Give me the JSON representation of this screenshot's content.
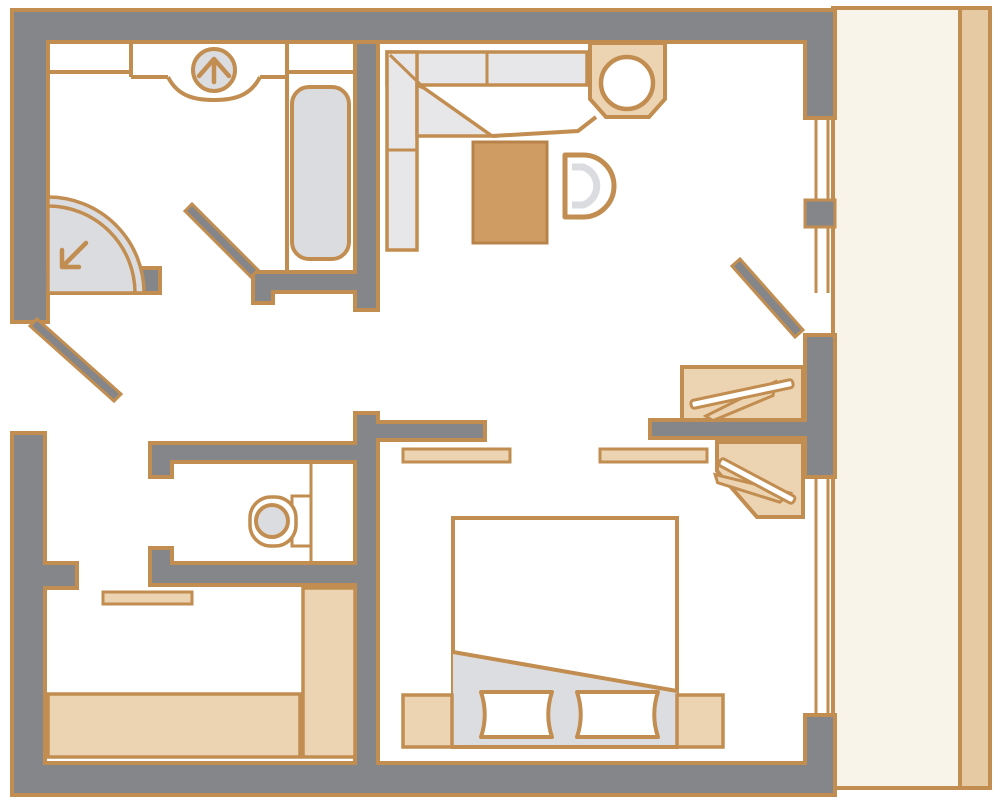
{
  "plan": {
    "kind": "apartment-floor-plan",
    "rooms": [
      {
        "name": "bathroom",
        "fixtures": [
          "vanity-counter",
          "washbasin",
          "bathtub",
          "corner-shower",
          "door"
        ]
      },
      {
        "name": "living-dining-area",
        "fixtures": [
          "corner-bench",
          "dining-table",
          "chair",
          "sink-unit",
          "wardrobe",
          "sliding-door-panels",
          "balcony-door"
        ]
      },
      {
        "name": "wc",
        "fixtures": [
          "toilet"
        ]
      },
      {
        "name": "entry-hall",
        "fixtures": [
          "entrance-door"
        ]
      },
      {
        "name": "bedroom",
        "fixtures": [
          "double-bed",
          "pillows",
          "nightstands",
          "wardrobe",
          "window"
        ]
      },
      {
        "name": "lower-room",
        "fixtures": [
          "sideboard",
          "tall-cabinet",
          "wall-shelf"
        ]
      },
      {
        "name": "balcony",
        "fixtures": [
          "railing"
        ]
      }
    ],
    "colors": {
      "wall": "#85868a",
      "line": "#c28d51",
      "furn": "#ecd4b2",
      "wood": "#cf9d63",
      "wood_edge": "#b8834a",
      "fix": "#dbdcdf",
      "bench": "#e7e7e9",
      "fold": "#dcdde0",
      "balcony": "#f9f4e9",
      "rail": "#e6caa4",
      "background": "#ffffff"
    }
  }
}
